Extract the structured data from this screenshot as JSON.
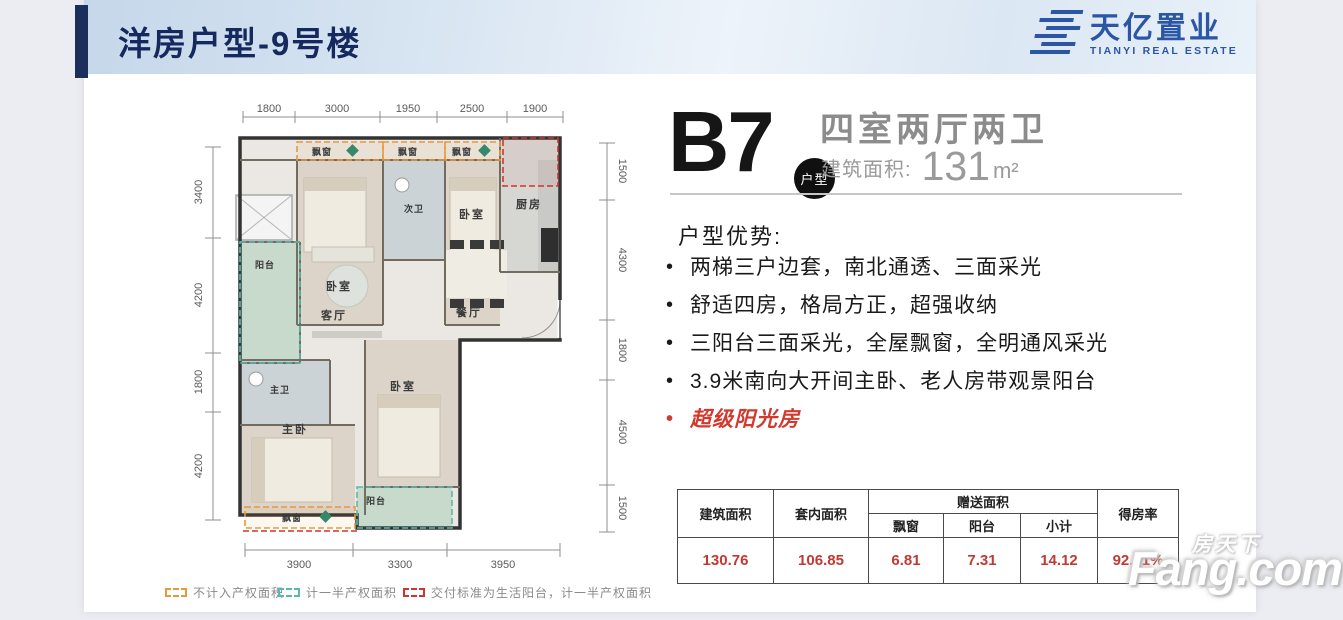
{
  "header": {
    "title": "洋房户型-9号楼",
    "title_color": "#16295e",
    "accent_color": "#1b2e5c",
    "logo": {
      "cn": "天亿置业",
      "en": "TIANYI REAL ESTATE",
      "color": "#2b55a5"
    }
  },
  "unit": {
    "code": "B7",
    "badge": "户型",
    "layout": "四室两厅两卫",
    "area_label": "建筑面积:",
    "area_value": "131",
    "area_unit": "m²"
  },
  "advantages": {
    "heading": "户型优势:",
    "items": [
      {
        "text": "两梯三户边套，南北通透、三面采光",
        "color": "#1a1a1a"
      },
      {
        "text": "舒适四房，格局方正，超强收纳",
        "color": "#1a1a1a"
      },
      {
        "text": "三阳台三面采光，全屋飘窗，全明通风采光",
        "color": "#1a1a1a"
      },
      {
        "text": "3.9米南向大开间主卧、老人房带观景阳台",
        "color": "#1a1a1a"
      },
      {
        "text": "超级阳光房",
        "color": "#d23a2e"
      }
    ]
  },
  "table": {
    "headers": {
      "jzmj": "建筑面积",
      "tnmj": "套内面积",
      "zsmj": "赠送面积",
      "pc": "飘窗",
      "yt": "阳台",
      "xj": "小计",
      "dfl": "得房率"
    },
    "values": {
      "jzmj": "130.76",
      "tnmj": "106.85",
      "pc": "6.81",
      "yt": "7.31",
      "xj": "14.12",
      "dfl": "92.51%"
    },
    "value_color": "#c13a32"
  },
  "legend": [
    {
      "label": "不计入产权面积",
      "color": "#e8983c"
    },
    {
      "label": "计一半产权面积",
      "color": "#5bb8ae"
    },
    {
      "label": "交付标准为生活阳台，计一半产权面积",
      "color": "#d0342c"
    }
  ],
  "floorplan": {
    "rooms": {
      "bay_top_1": "飘窗",
      "bay_top_2": "飘窗",
      "bay_top_3": "飘窗",
      "second_bath": "次卫",
      "bedroom_tl": "卧室",
      "bedroom_tr": "卧室",
      "kitchen": "厨房",
      "balcony_left": "阳台",
      "living": "客厅",
      "dining": "餐厅",
      "master_bath": "主卫",
      "master_bed": "主卧",
      "bedroom_b": "卧室",
      "bay_bottom": "飘窗",
      "balcony_bottom": "阳台"
    },
    "dims": {
      "top": [
        "1800",
        "3000",
        "1950",
        "2500",
        "1900"
      ],
      "left": [
        "3400",
        "4200",
        "1800",
        "4200"
      ],
      "right": [
        "1500",
        "4300",
        "1800",
        "4500",
        "1500"
      ],
      "bottom": [
        "3900",
        "3300",
        "3950"
      ]
    }
  },
  "watermark": {
    "cn": "房天下",
    "en": "Fang.com"
  }
}
